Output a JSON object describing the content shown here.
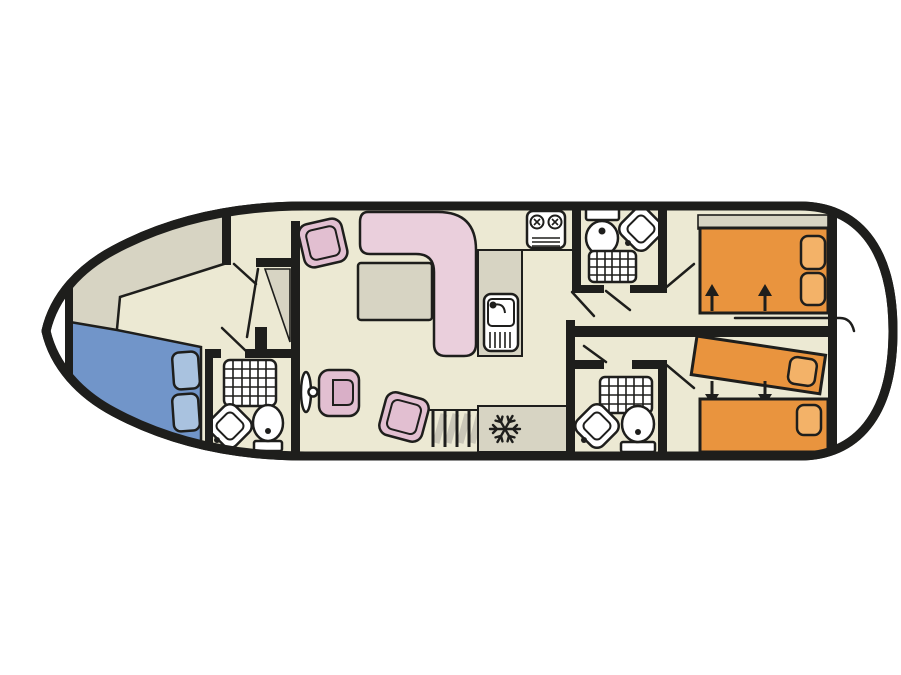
{
  "title": "Boat deck floor plan",
  "colors": {
    "wall": "#1e1e1c",
    "floor": "#ece9d3",
    "area_grey": "#d7d4c3",
    "hull_white": "#ffffff",
    "fixture_white": "#ffffff",
    "bed_blue": "#7195c9",
    "pillow_blue": "#a9c2df",
    "bed_orange": "#e9943e",
    "pillow_orange": "#f3b268",
    "sofa_pink": "#eacfdc",
    "chair_pink": "#e2bfd1",
    "chair_pink_inner": "#d9afc7",
    "table_grey": "#d7d4c3",
    "shading_grey": "#c9c6b7"
  },
  "rooms": {
    "bow_locker": {
      "name": "bow locker",
      "items": []
    },
    "bow_cabin": {
      "name": "bow cabin",
      "items": [
        "double-bed-blue",
        "two-pillows",
        "corner-wardrobe"
      ]
    },
    "bow_bathroom": {
      "name": "forward bathroom",
      "items": [
        "shower",
        "corner-sink",
        "toilet"
      ]
    },
    "saloon": {
      "name": "saloon / wheelhouse",
      "items": [
        "armchair",
        "l-shaped-sofa",
        "table",
        "steering-wheel",
        "helm-seat",
        "armchair",
        "stairs"
      ]
    },
    "galley": {
      "name": "galley",
      "items": [
        "stove-two-burner",
        "sink-with-drainer",
        "counter",
        "fridge"
      ]
    },
    "top_bathroom": {
      "name": "midship bathroom (port)",
      "items": [
        "toilet",
        "corner-sink",
        "shower"
      ]
    },
    "bottom_bathroom": {
      "name": "midship bathroom (starboard)",
      "items": [
        "shower",
        "corner-sink",
        "toilet"
      ]
    },
    "stern_cabin_top": {
      "name": "aft cabin (port)",
      "items": [
        "double-bed-orange",
        "two-pillows",
        "slide-arrows-up",
        "headboard-shelf"
      ]
    },
    "stern_cabin_bottom": {
      "name": "aft cabin (starboard)",
      "items": [
        "single-bed-angled",
        "single-bed",
        "pillows",
        "slide-arrows-down"
      ]
    },
    "stern_deck": {
      "name": "stern deck",
      "items": []
    }
  },
  "icons": [
    "stove-icon",
    "galley-sink-icon",
    "fridge-snowflake-icon",
    "shower-icon",
    "toilet-icon",
    "corner-sink-icon",
    "steering-wheel-icon",
    "stairs-icon",
    "bed-arrow-up-icon",
    "bed-arrow-down-icon",
    "door-swing-line"
  ]
}
